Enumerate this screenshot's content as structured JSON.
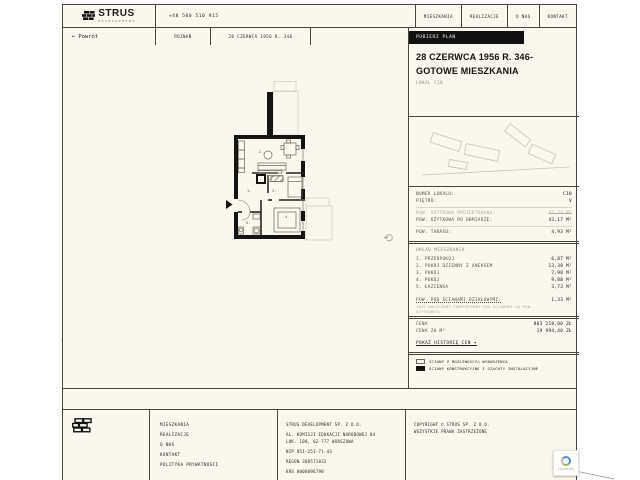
{
  "logo": {
    "name": "STRUS",
    "tagline": "DEVELOPMENT"
  },
  "header": {
    "phone": "+48 500 510 915",
    "nav": [
      {
        "label": "MIESZKANIA"
      },
      {
        "label": "REALIZACJE"
      },
      {
        "label": "O NAS"
      },
      {
        "label": "KONTAKT"
      }
    ],
    "back_arrow": "←",
    "back": "Powrót",
    "breadcrumb": {
      "city": "POZNAŃ",
      "investment": "28 CZERWCA 1956 R. 346"
    }
  },
  "sidebar": {
    "download_button": "POBIERZ PLAN",
    "title": "28 CZERWCA 1956 R. 346- GOTOWE MIESZKANIA",
    "unit_label": "LOKAL C18",
    "details": [
      {
        "label": "NUMER LOKALU:",
        "value": "C18"
      },
      {
        "label": "PIĘTRO:",
        "value": "V"
      },
      {
        "label": "POW. UŻYTKOWA PROJEKTOWANA:",
        "value": "43,74 M²"
      },
      {
        "label": "POW. UŻYTKOWA PO OBMIARZE:",
        "value": "43,17 M²"
      },
      {
        "label": "POW. TARASU:",
        "value": "4,93 M²"
      }
    ],
    "layout_header": "UKŁAD MIESZKANIA",
    "rooms": [
      {
        "name": "1. PRZEDPOKÓJ",
        "area": "6,87 M²"
      },
      {
        "name": "2. POKÓJ DZIENNY Z ANEKSEM",
        "area": "13,38 M²"
      },
      {
        "name": "3. POKÓJ",
        "area": "7,98 M²"
      },
      {
        "name": "4. POKÓJ",
        "area": "9,88 M²"
      },
      {
        "name": "5. ŁAZIENKA",
        "area": "3,73 M²"
      }
    ],
    "walls_row": {
      "label": "POW. POD ŚCIANAMI DZIAŁOWYMI:",
      "value": "1,33 M²"
    },
    "walls_note_1": "(NIE DOLICZAMY POWIERZCHNI POD ŚCIANAMI DO POW.",
    "walls_note_2": "UŻYTKOWEJ)",
    "price_rows": [
      {
        "label": "CENA",
        "value": "863 218,00 ZŁ"
      },
      {
        "label": "CENA ZA M²",
        "value": "19 994,40 ZŁ"
      }
    ],
    "history_link": "POKAŻ HISTORIĘ CEN ▾",
    "legend": [
      {
        "label": "ŚCIANY Z MOŻLIWOŚCIĄ WYBURZENIA"
      },
      {
        "label": "ŚCIANY KONSTRUKCYJNE I SZACHTY INSTALACYJNE"
      }
    ]
  },
  "plan": {
    "room_numbers": [
      "1.",
      "2.",
      "3.",
      "4.",
      "5."
    ]
  },
  "footer": {
    "links": [
      "MIESZKANIA",
      "REALIZACJE",
      "O NAS",
      "KONTAKT",
      "POLITYKA PRYWATNOŚCI"
    ],
    "company": {
      "name": "STRUS DEVELOPMENT SP. Z O.O.",
      "address_1": "AL. KOMISJI EDUKACJI NARODOWEJ 84",
      "address_2": "LOK. 108, 02-777 WARSZAWA",
      "nip": "NIP 951-251-71-43",
      "regon": "REGON 388571832",
      "krs": "KRS 0000896790"
    },
    "copyright_1": "COPYRIGHT © STRUS SP. Z O.O.",
    "copyright_2": "WSZYSTKIE PRAWA ZASTRZEŻONE",
    "recaptcha": "reCAPTCHA"
  },
  "colors": {
    "background": "#faf7ee",
    "accent": "#121212",
    "muted": "#8f897c",
    "recaptcha_blue": "#4a90e2"
  }
}
